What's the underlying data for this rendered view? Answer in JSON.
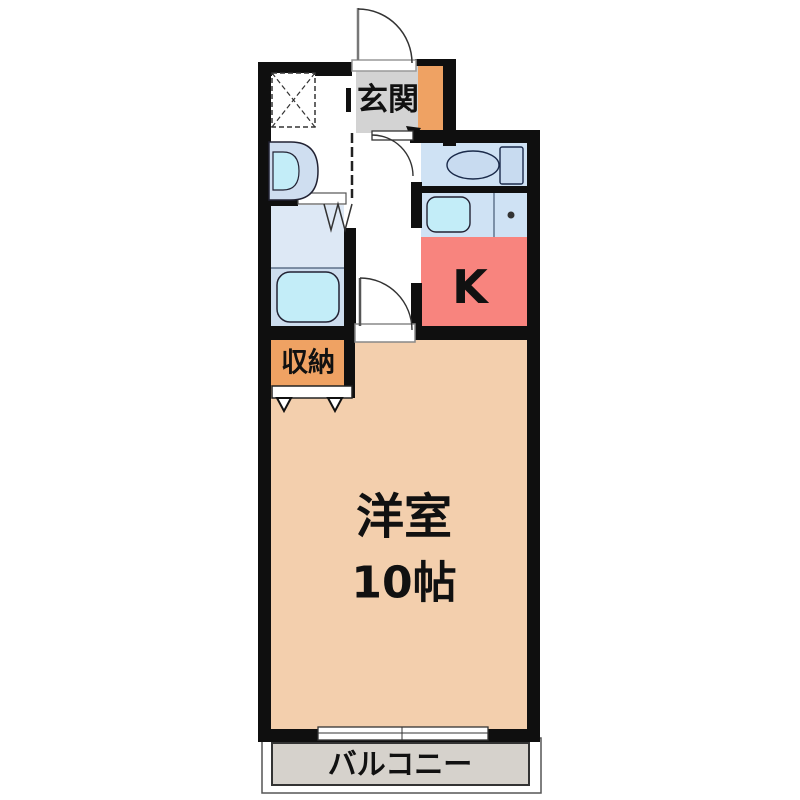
{
  "floor_plan": {
    "type": "japanese-apartment-floorplan",
    "labels": {
      "genkan": "玄関",
      "kitchen": "K",
      "storage": "収納",
      "main_room": "洋室",
      "main_room_size": "10帖",
      "balcony": "バルコニー"
    },
    "rooms": [
      {
        "name": "entrance",
        "label": "玄関",
        "color": "#d3d3d3"
      },
      {
        "name": "kitchen",
        "label": "K",
        "color": "#f8847e"
      },
      {
        "name": "storage-closet",
        "label": "収納",
        "color": "#efa263"
      },
      {
        "name": "western-room",
        "label": "洋室",
        "size": "10帖",
        "color": "#f3cfad"
      },
      {
        "name": "balcony",
        "label": "バルコニー",
        "color": "#d6d2cc"
      },
      {
        "name": "bathroom",
        "color": "#dde8f5"
      },
      {
        "name": "toilet-room",
        "color": "#cfe2f4"
      }
    ],
    "colors": {
      "wall": "#0f0f0f",
      "genkan_tile": "#d3d3d3",
      "entrance_orange": "#efa263",
      "kitchen_pink": "#f8847e",
      "room_peach": "#f3cfad",
      "balcony_gray": "#d6d2cc",
      "water_blue": "#cfe2f4",
      "bath_upper": "#dde8f5",
      "bath_lower": "#cdddee",
      "basin_cyan": "#c3edf8",
      "fixture_blue": "#c8dbf0",
      "text": "#111111"
    }
  }
}
